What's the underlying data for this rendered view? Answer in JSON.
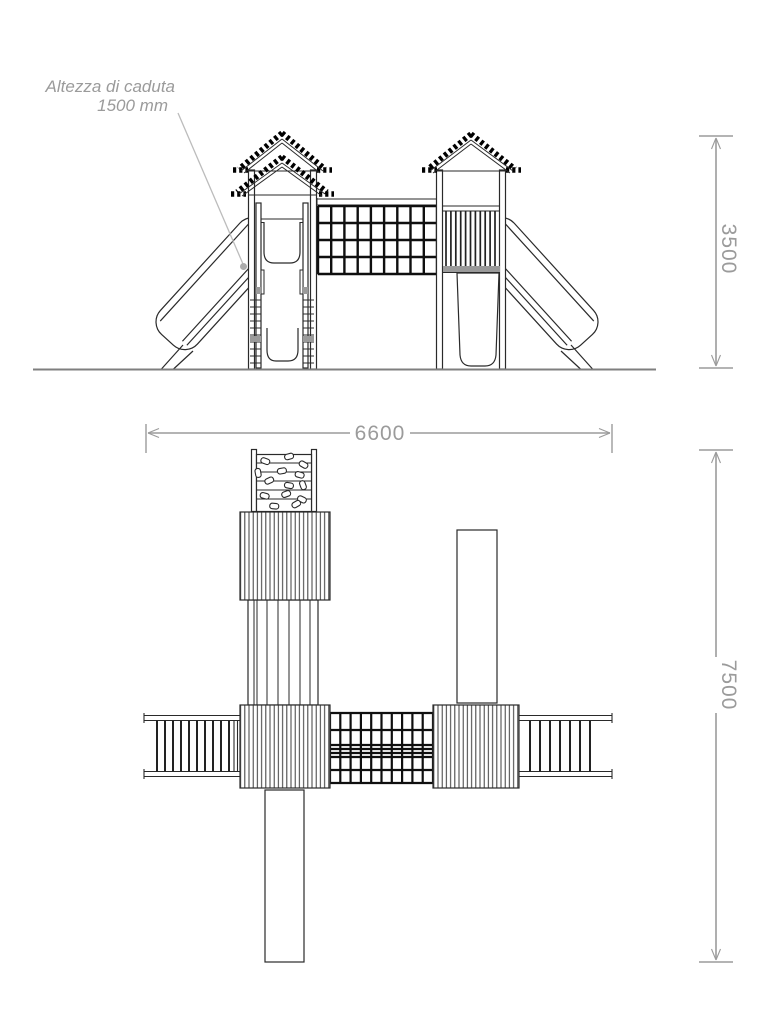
{
  "drawing": {
    "type": "technical-drawing",
    "subject": "playground structure with two towers, net bridge, slides, ladders and climbing wall",
    "views": [
      "front elevation",
      "plan view"
    ]
  },
  "annotation": {
    "line1": "Altezza di caduta",
    "line2": "1500 mm"
  },
  "dimensions": {
    "height": "3500",
    "width": "6600",
    "depth": "7500"
  },
  "colors": {
    "line": "#2a2a2a",
    "heavy_line": "#0f0f0f",
    "dimension": "#9b9b9b",
    "ground": "#7f7f7f",
    "gray_fill": "#9a9a9a",
    "background": "#ffffff"
  }
}
